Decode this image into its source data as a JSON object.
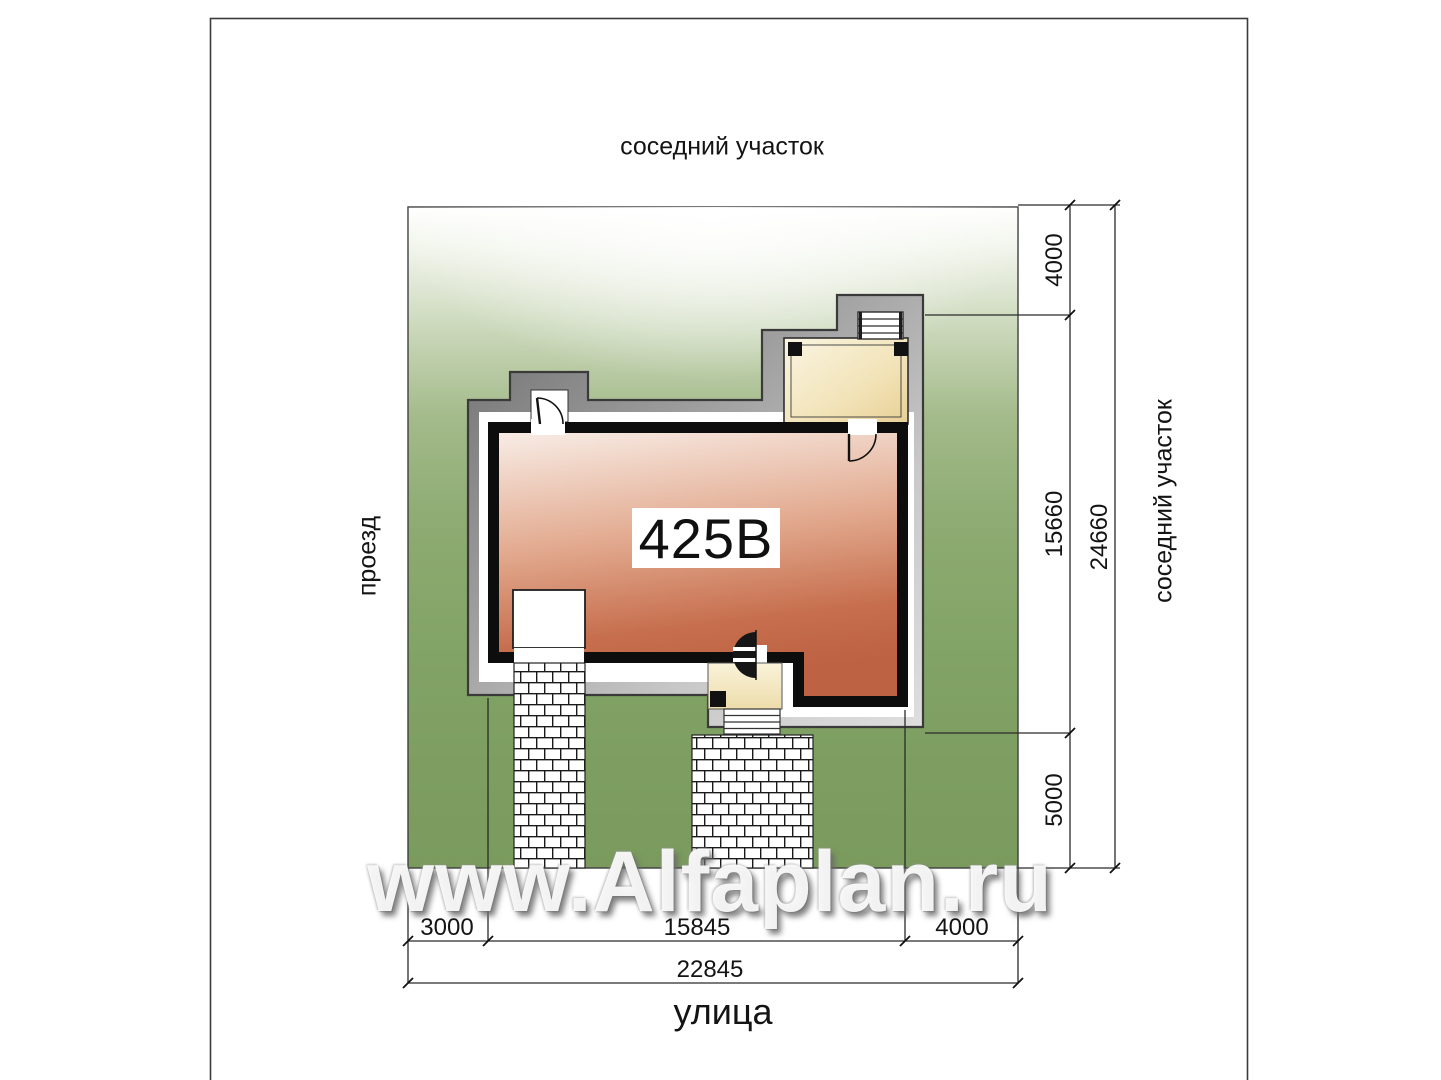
{
  "plan": {
    "house_number": "425В",
    "watermark": "www.Alfaplan.ru",
    "labels": {
      "neighbor_top": "соседний участок",
      "neighbor_right": "соседний участок",
      "driveway": "проезд",
      "street": "улица"
    },
    "dimensions": {
      "setback_top": "4000",
      "house_depth": "15660",
      "plot_depth": "24660",
      "setback_bottom": "5000",
      "setback_left": "3000",
      "house_width": "15845",
      "setback_right": "4000",
      "plot_width": "22845"
    },
    "colors": {
      "lawn_dark": "#7a9b5d",
      "lawn_mid": "#8dab72",
      "roof_dark": "#6e6e6e",
      "roof_light": "#dedede",
      "floor_light": "#f8ece5",
      "floor_dark": "#bd6243",
      "terrace_cream": "#ecd69e",
      "wall": "#0d0d0d"
    }
  }
}
